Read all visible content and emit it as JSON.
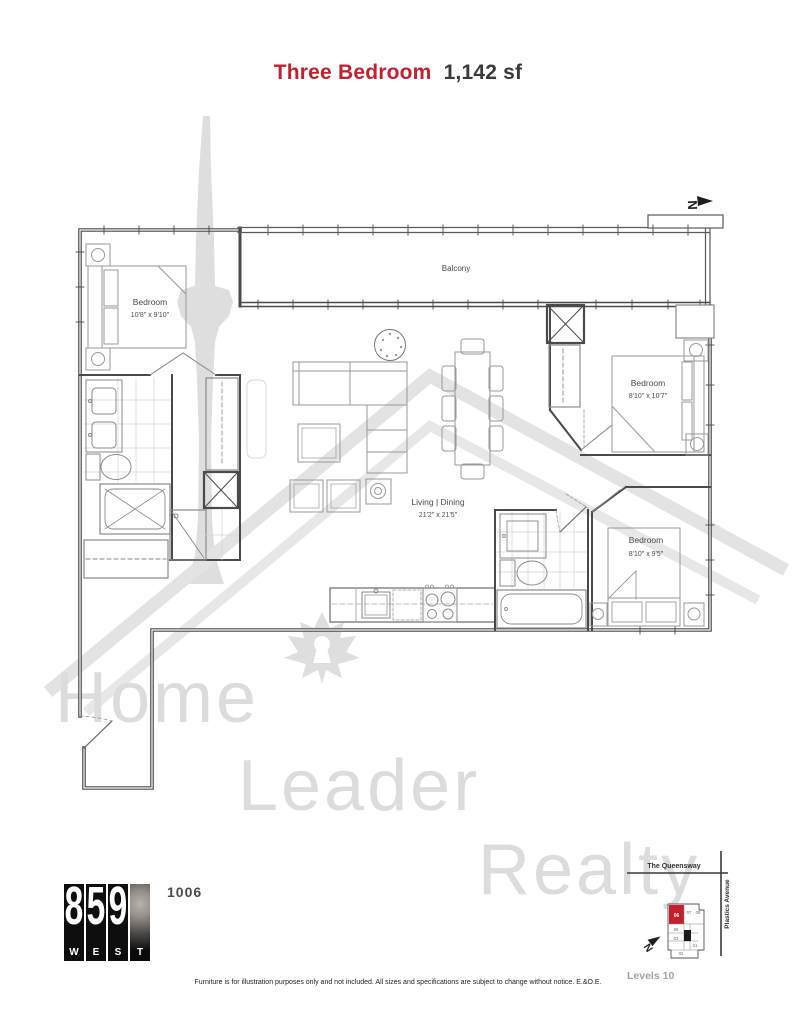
{
  "title": {
    "type": "Three Bedroom",
    "size": "1,142 sf"
  },
  "plan": {
    "balcony": "Balcony",
    "bedroom1": {
      "name": "Bedroom",
      "dims": "10'8\" x 9'10\""
    },
    "bedroom2": {
      "name": "Bedroom",
      "dims": "8'10\" x 10'7\""
    },
    "bedroom3": {
      "name": "Bedroom",
      "dims": "8'10\" x 9'5\""
    },
    "living": {
      "name": "Living | Dining",
      "dims": "21'2\" x 21'5\""
    }
  },
  "watermark": {
    "word1": "Home",
    "word2": "Leader",
    "word3": "Realty"
  },
  "compass": {
    "n": "N"
  },
  "logo": {
    "d1": "8",
    "d2": "5",
    "d3": "9",
    "l1": "W",
    "l2": "E",
    "l3": "S",
    "l4": "T"
  },
  "unit_number": "1006",
  "keyplan": {
    "street_top": "The Queensway",
    "street_right": "Plastics Avenue",
    "levels": "Levels 10",
    "u06": "06",
    "u07": "07",
    "u08": "08",
    "u05": "05",
    "u03": "03",
    "u02": "02",
    "u01": "01",
    "highlight_color": "#c51f2b"
  },
  "colors": {
    "title_accent": "#c0222f",
    "wall": "#4a4a4a"
  },
  "disclaimer": "Furniture is for illustration purposes only and not included. All sizes and specifications are subject to change without notice. E.&O.E."
}
